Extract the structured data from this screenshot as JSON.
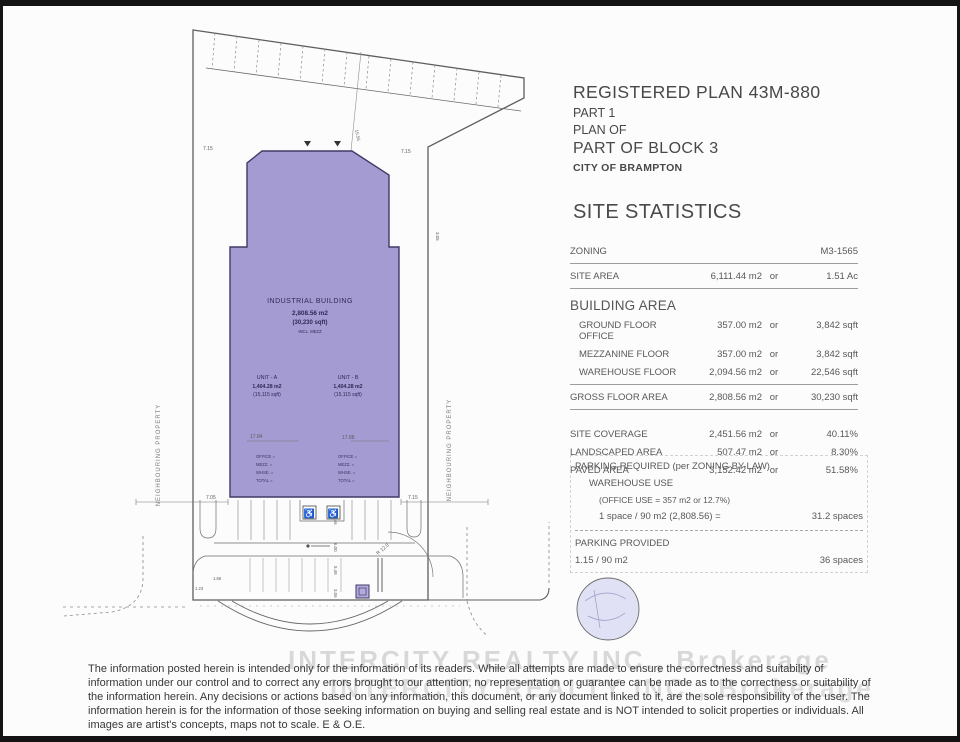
{
  "title_block": {
    "line1": "REGISTERED PLAN 43M-880",
    "line2": "PART 1",
    "line3": "PLAN OF",
    "line4": "PART OF BLOCK 3",
    "line5": "CITY OF BRAMPTON"
  },
  "stats": {
    "heading": "SITE STATISTICS",
    "rows": [
      {
        "type": "first rule-below",
        "label": "ZONING",
        "v1": "",
        "or": "",
        "v2": "M3-1565"
      },
      {
        "type": "rule-below",
        "label": "SITE AREA",
        "v1": "6,111.44 m2",
        "or": "or",
        "v2": "1.51 Ac"
      },
      {
        "type": "section",
        "label": "BUILDING AREA",
        "v1": "",
        "or": "",
        "v2": ""
      },
      {
        "type": "sub",
        "label": "GROUND FLOOR OFFICE",
        "v1": "357.00 m2",
        "or": "or",
        "v2": "3,842 sqft"
      },
      {
        "type": "sub",
        "label": "MEZZANINE FLOOR",
        "v1": "357.00 m2",
        "or": "or",
        "v2": "3,842 sqft"
      },
      {
        "type": "sub rule-below",
        "label": "WAREHOUSE FLOOR",
        "v1": "2,094.56 m2",
        "or": "or",
        "v2": "22,546 sqft"
      },
      {
        "type": "rule-below",
        "label": "GROSS FLOOR AREA",
        "v1": "2,808.56 m2",
        "or": "or",
        "v2": "30,230 sqft"
      },
      {
        "type": "gap",
        "label": "SITE COVERAGE",
        "v1": "2,451.56 m2",
        "or": "or",
        "v2": "40.11%"
      },
      {
        "type": "",
        "label": "LANDSCAPED AREA",
        "v1": "507.47 m2",
        "or": "or",
        "v2": "8.30%"
      },
      {
        "type": "",
        "label": "PAVED AREA",
        "v1": "3,152.42 m2",
        "or": "or",
        "v2": "51.58%"
      }
    ]
  },
  "parking": {
    "required_heading": "PARKING REQUIRED (per ZONING BY-LAW)",
    "use": "WAREHOUSE USE",
    "office_note": "(OFFICE USE = 357 m2  or  12.7%)",
    "calc": "1 space / 90 m2 (2,808.56) =",
    "calc_value": "31.2 spaces",
    "provided_heading": "PARKING PROVIDED",
    "provided_ratio": "1.15 / 90 m2",
    "provided_value": "36 spaces"
  },
  "plan": {
    "building": {
      "name": "INDUSTRIAL BUILDING",
      "area_m2": "2,808.56 m2",
      "area_sqft": "(30,230 sqft)",
      "note": "INCL. MEZZ",
      "units": [
        {
          "name": "UNIT - A",
          "m2": "1,404.28 m2",
          "sqft": "(15,115 sqft)"
        },
        {
          "name": "UNIT - B",
          "m2": "1,404.28 m2",
          "sqft": "(15,115 sqft)"
        }
      ],
      "unit_details": [
        "OFFICE =",
        "MEZZ. =",
        "WHSE. =",
        "TOTAL ="
      ]
    },
    "neighbouring_left": "NEIGHBOURING PROPERTY",
    "neighbouring_right": "NEIGHBOURING PROPERTY",
    "accessible_glyph": "♿",
    "dims": {
      "top_left": "7.15",
      "top_right": "7.15",
      "slant": "15.56",
      "width_a": "17.84",
      "width_b": "17.88",
      "bottom_left": "7.05",
      "bottom_right": "7.15",
      "radius": "R 12.0",
      "aisle1": "5.46",
      "aisle2": "6.00",
      "aisle3": "5.48",
      "aisle4": "3.06",
      "curb1": "1.66",
      "curb2": "1.23",
      "side_right": "3.05"
    }
  },
  "watermark": {
    "line1": "INTERCITY REALTY INC., Brokerage",
    "line2": "INTERCITY REALTY INC., Brokerage"
  },
  "disclaimer": "The information posted herein is intended only for the information of its readers.  While all attempts are made to ensure the correctness and suitability of information under our control and to correct any errors brought to our attention, no representation or guarantee can be made as to the correctness or suitability of the information herein.  Any decisions or actions based on any information, this document, or any document linked to it, are the sole responsibility of the user.  The information herein is for the information of those seeking information on buying and selling real estate and is NOT intended to solicit properties or individuals.  All images are artist's concepts, maps not to scale.  E & O.E."
}
